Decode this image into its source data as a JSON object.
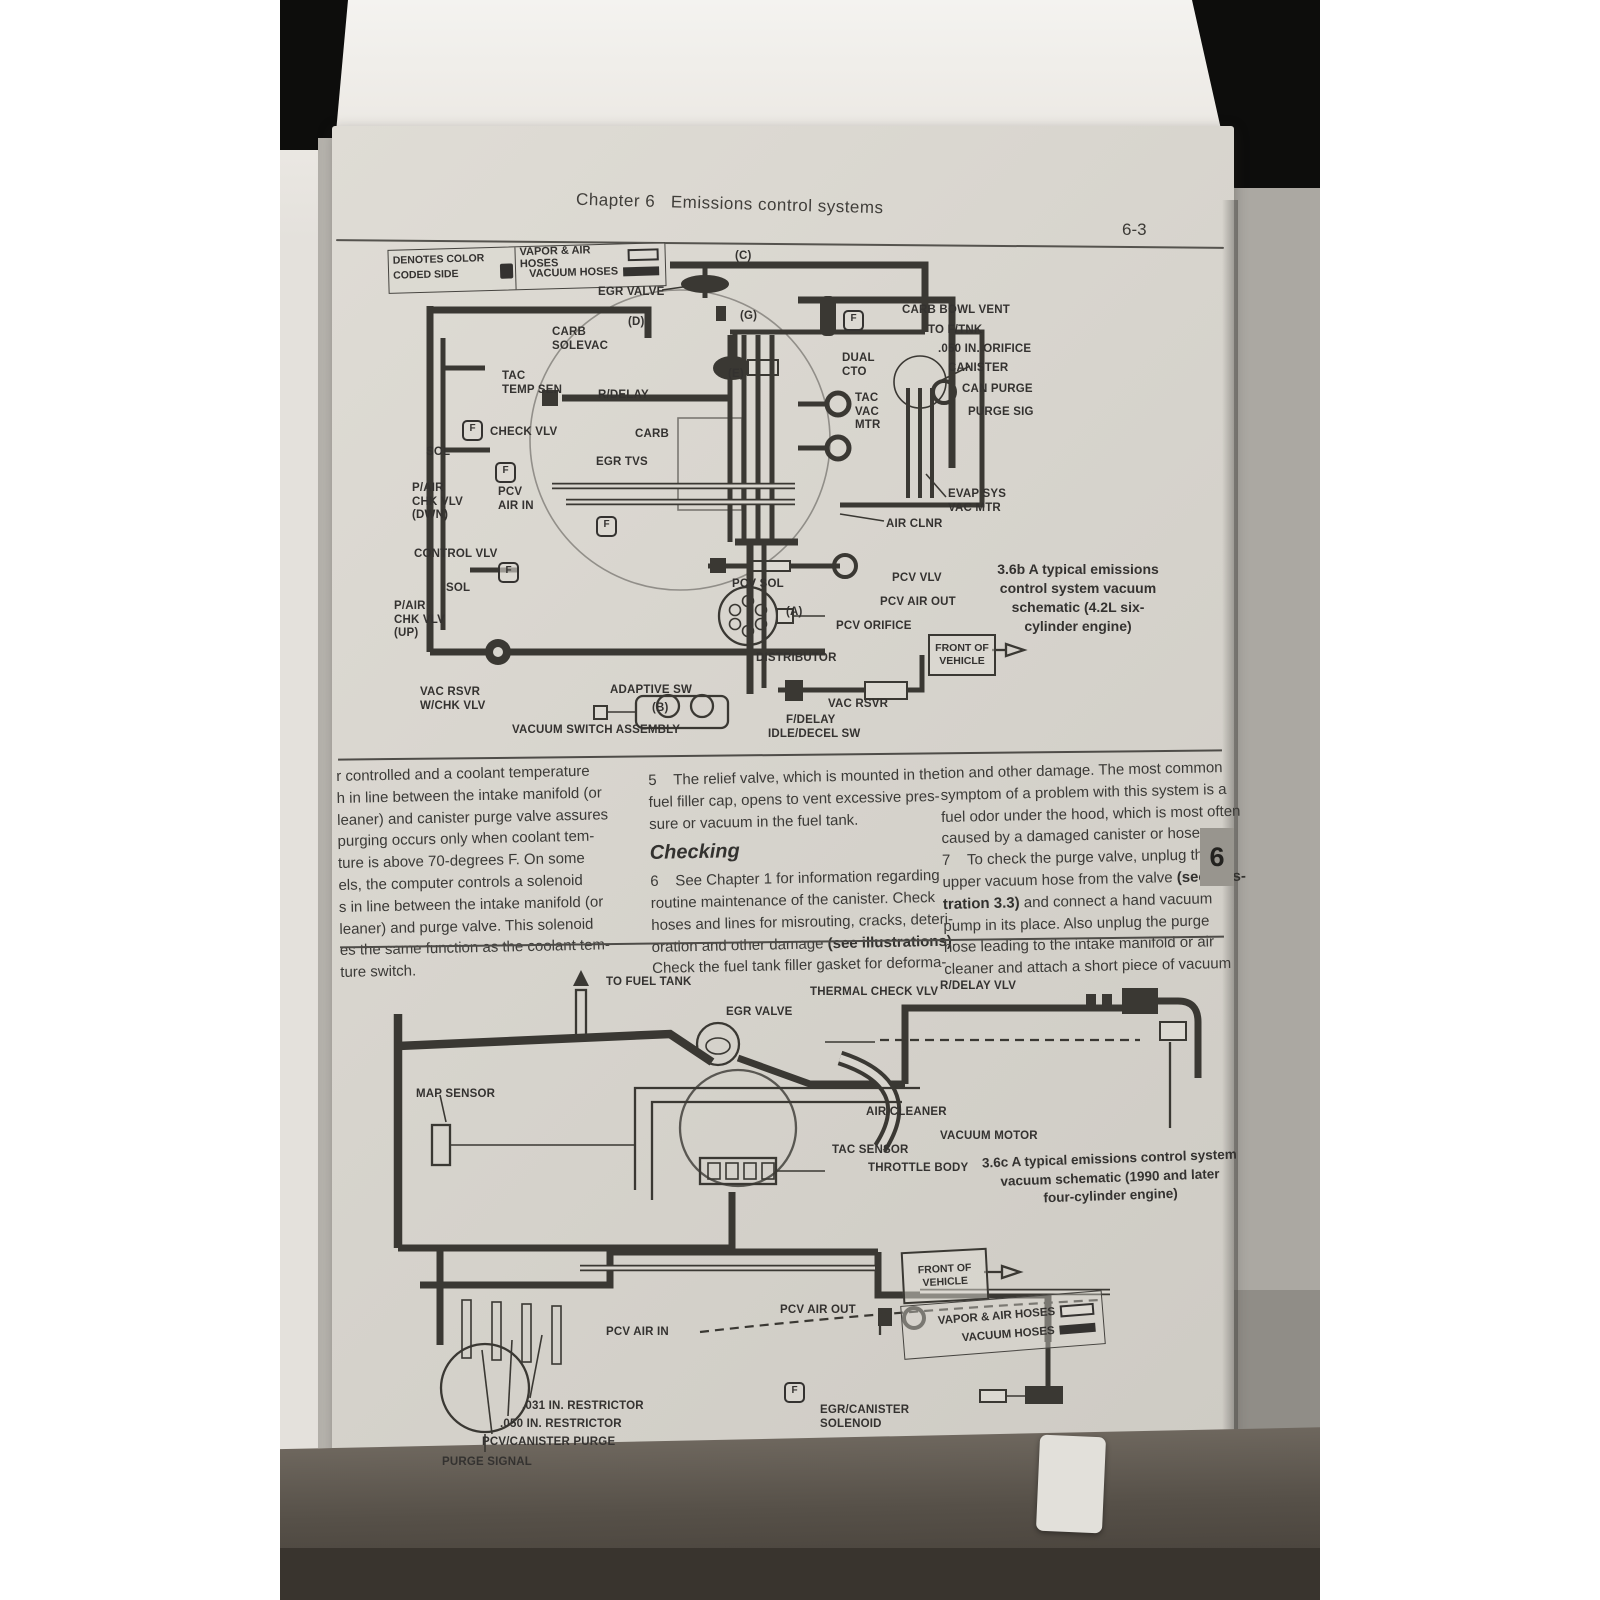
{
  "header": {
    "chapter_title": "Chapter 6   Emissions control systems",
    "page_number": "6-3"
  },
  "page_tab": "6",
  "f_glyph": "F",
  "legend_top": {
    "left_line1": "DENOTES COLOR",
    "left_line2": "CODED SIDE",
    "vapor_label": "VAPOR & AIR HOSES",
    "vacuum_label": "VACUUM HOSES"
  },
  "legend_bottom": {
    "vapor_label": "VAPOR & AIR HOSES",
    "vacuum_label": "VACUUM HOSES"
  },
  "diagram1": {
    "caption": "3.6b  A typical emissions\ncontrol system vacuum\nschematic (4.2L six-\ncylinder engine)",
    "front_of_vehicle": "FRONT OF\nVEHICLE",
    "labels": [
      {
        "t": "(C)",
        "x": 455,
        "y": 250
      },
      {
        "t": "EGR VALVE",
        "x": 318,
        "y": 286
      },
      {
        "t": "(D)",
        "x": 348,
        "y": 316
      },
      {
        "t": "(G)",
        "x": 460,
        "y": 310
      },
      {
        "t": "CARB\nSOLEVAC",
        "x": 272,
        "y": 326
      },
      {
        "t": "(E)",
        "x": 448,
        "y": 368
      },
      {
        "t": "DUAL\nCTO",
        "x": 562,
        "y": 352
      },
      {
        "t": "CARB BOWL VENT",
        "x": 622,
        "y": 304
      },
      {
        "t": "TO F/TNK",
        "x": 648,
        "y": 324
      },
      {
        "t": ".050 IN. ORIFICE",
        "x": 658,
        "y": 343
      },
      {
        "t": "CANISTER",
        "x": 668,
        "y": 362
      },
      {
        "t": "CAN PURGE",
        "x": 682,
        "y": 383
      },
      {
        "t": "PURGE SIG",
        "x": 688,
        "y": 406
      },
      {
        "t": "TAC\nTEMP SEN",
        "x": 222,
        "y": 370
      },
      {
        "t": "R/DELAY",
        "x": 318,
        "y": 389
      },
      {
        "t": "TAC\nVAC\nMTR",
        "x": 575,
        "y": 392
      },
      {
        "t": "CHECK VLV",
        "x": 210,
        "y": 426
      },
      {
        "t": "CARB",
        "x": 355,
        "y": 428
      },
      {
        "t": "SOL",
        "x": 146,
        "y": 446
      },
      {
        "t": "EGR TVS",
        "x": 316,
        "y": 456
      },
      {
        "t": "P/AIR\nCHK VLV\n(DWN)",
        "x": 132,
        "y": 482
      },
      {
        "t": "PCV\nAIR IN",
        "x": 218,
        "y": 486
      },
      {
        "t": "CONTROL VLV",
        "x": 134,
        "y": 548
      },
      {
        "t": "SOL",
        "x": 166,
        "y": 582
      },
      {
        "t": "P/AIR\nCHK VLV\n(UP)",
        "x": 114,
        "y": 600
      },
      {
        "t": "EVAP SYS\nVAC MTR",
        "x": 668,
        "y": 488
      },
      {
        "t": "AIR CLNR",
        "x": 606,
        "y": 518
      },
      {
        "t": "PCV SOL",
        "x": 452,
        "y": 578
      },
      {
        "t": "PCV VLV",
        "x": 612,
        "y": 572
      },
      {
        "t": "PCV AIR OUT",
        "x": 600,
        "y": 596
      },
      {
        "t": "(A)",
        "x": 506,
        "y": 606
      },
      {
        "t": "PCV ORIFICE",
        "x": 556,
        "y": 620
      },
      {
        "t": "DISTRIBUTOR",
        "x": 476,
        "y": 652
      },
      {
        "t": "VAC RSVR\nW/CHK VLV",
        "x": 140,
        "y": 686
      },
      {
        "t": "ADAPTIVE SW",
        "x": 330,
        "y": 684
      },
      {
        "t": "(B)",
        "x": 372,
        "y": 702
      },
      {
        "t": "VAC RSVR",
        "x": 548,
        "y": 698
      },
      {
        "t": "F/DELAY",
        "x": 506,
        "y": 714
      },
      {
        "t": "IDLE/DECEL SW",
        "x": 488,
        "y": 728
      },
      {
        "t": "VACUUM SWITCH ASSEMBLY",
        "x": 232,
        "y": 724
      }
    ],
    "f_icons": [
      {
        "x": 182,
        "y": 420
      },
      {
        "x": 215,
        "y": 462
      },
      {
        "x": 218,
        "y": 562
      },
      {
        "x": 563,
        "y": 310
      },
      {
        "x": 316,
        "y": 516
      }
    ]
  },
  "diagram2": {
    "caption": "3.6c  A typical emissions control system\nvacuum schematic (1990 and later\nfour-cylinder engine)",
    "front_of_vehicle": "FRONT OF\nVEHICLE",
    "labels": [
      {
        "t": "TO FUEL TANK",
        "x": 326,
        "y": 976
      },
      {
        "t": "EGR VALVE",
        "x": 446,
        "y": 1006
      },
      {
        "t": "THERMAL CHECK VLV",
        "x": 530,
        "y": 986
      },
      {
        "t": "R/DELAY VLV",
        "x": 660,
        "y": 980
      },
      {
        "t": "MAP SENSOR",
        "x": 136,
        "y": 1088
      },
      {
        "t": "AIR CLEANER",
        "x": 586,
        "y": 1106
      },
      {
        "t": "VACUUM MOTOR",
        "x": 660,
        "y": 1130
      },
      {
        "t": "TAC SENSOR",
        "x": 552,
        "y": 1144
      },
      {
        "t": "THROTTLE BODY",
        "x": 588,
        "y": 1162
      },
      {
        "t": "PCV AIR IN",
        "x": 326,
        "y": 1326
      },
      {
        "t": "PCV AIR OUT",
        "x": 500,
        "y": 1304
      },
      {
        "t": ".031 IN. RESTRICTOR",
        "x": 242,
        "y": 1400
      },
      {
        "t": ".050 IN. RESTRICTOR",
        "x": 220,
        "y": 1418
      },
      {
        "t": "PCV/CANISTER PURGE",
        "x": 202,
        "y": 1436
      },
      {
        "t": "PURGE SIGNAL",
        "x": 162,
        "y": 1456
      },
      {
        "t": "EGR/CANISTER\nSOLENOID",
        "x": 540,
        "y": 1404
      }
    ],
    "f_icons": [
      {
        "x": 504,
        "y": 1382
      }
    ]
  },
  "columns": {
    "col1_lines": [
      "r controlled and a coolant temperature",
      "h in line between the intake manifold (or",
      "leaner) and canister purge valve assures",
      "purging occurs only when coolant tem-",
      "ture is above 70-degrees F. On some",
      "els, the computer controls a solenoid",
      "s in line between the intake manifold (or",
      "leaner) and purge valve. This solenoid",
      "es the same function as the coolant tem-",
      "ture switch."
    ],
    "col2_para1": [
      "5    The relief valve, which is mounted in the",
      "fuel filler cap, opens to vent excessive pres-",
      "sure or vacuum in the fuel tank."
    ],
    "col2_heading": "Checking",
    "col2_para2": [
      "6    See Chapter 1 for information regarding",
      "routine maintenance of the canister. Check",
      "hoses and lines for misrouting, cracks, deteri-",
      "oration and other damage **(see illustrations)**.",
      "Check the fuel tank filler gasket for deforma-"
    ],
    "col3_lines": [
      "tion and other damage. The most common",
      "symptom of a problem with this system is a",
      "fuel odor under the hood, which is most often",
      "caused by a damaged canister or hoses.",
      "7    To check the purge valve, unplug the",
      "upper vacuum hose from the valve **(see illus-**",
      "**tration 3.3)** and connect a hand vacuum",
      "pump in its place. Also unplug the purge",
      "hose leading to the intake manifold or air",
      "cleaner and attach a short piece of vacuum"
    ]
  }
}
